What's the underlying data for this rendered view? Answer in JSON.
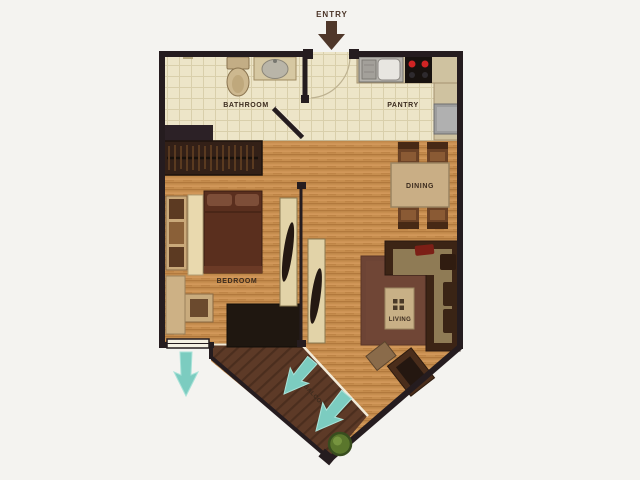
{
  "labels": {
    "entry": "ENTRY",
    "bathroom": "BATHROOM",
    "pantry": "PANTRY",
    "dining": "DINING",
    "bedroom": "BEDROOM",
    "living": "LIVING",
    "balcony": "BALCONY"
  },
  "icons": {
    "entry_arrow": "solid brown down-arrow",
    "view_arrow": "tapered teal arrow",
    "plant": "round green potted plant",
    "stove": "cooktop with two red burners",
    "sink": "kitchen sink with drainboard",
    "toilet": "toilet with tank",
    "basin": "oval vanity basin"
  },
  "colors": {
    "background": "#f4f3f0",
    "wall": "#251c1f",
    "tile_floor": "#ede5c8",
    "tile_grid": "#d9cfab",
    "wood_floor": "#c78e4f",
    "balcony_floor": "#5d3a27",
    "glass_edge": "#f2ead8",
    "rug": "#6d4435",
    "sofa": "#3c2415",
    "sofa_seat": "#8f7b55",
    "red_pillow": "#7c1f16",
    "bed": "#5a2f1e",
    "pillow": "#7d4e38",
    "counter": "#cfc2a0",
    "appliance_gray": "#b5b2ac",
    "stove_black": "#18120f",
    "burner_red": "#d02424",
    "fridge_gray": "#9d9d9d",
    "dining_table": "#c9ae85",
    "chair_brown": "#6b4226",
    "closet_dark": "#332017",
    "panel_cream": "#e2d3a8",
    "teal_arrow": "#7cccc0",
    "entry_arrow": "#4f372a",
    "plant_green": "#5a762c",
    "label_text": "#3b2b1e"
  }
}
